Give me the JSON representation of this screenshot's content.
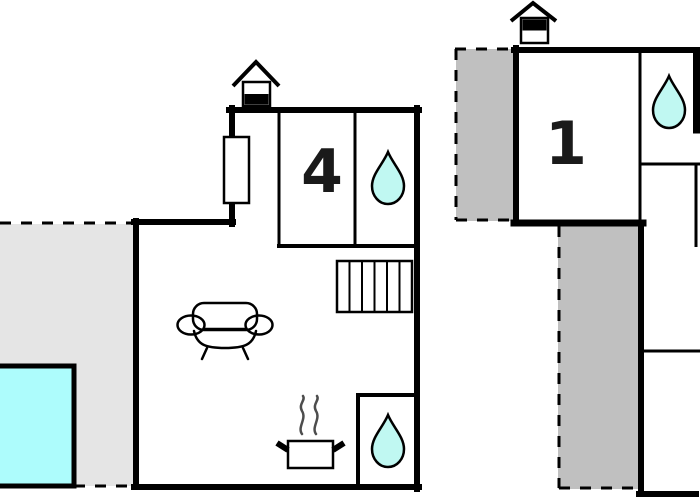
{
  "floor_plan": {
    "type": "vacation-home floor plan, two buildings",
    "labels": {
      "room4": "4",
      "room1": "1"
    },
    "icons": {
      "chimney": "house-chimney-icon",
      "water_drop": "water-drop-icon",
      "sofa": "sofa-icon",
      "stove": "stove-steam-icon",
      "stairs": "stairs-icon",
      "window": "window-icon",
      "pool": "pool-square",
      "terrace": "dashed-terrace-area"
    },
    "colors": {
      "wall": "#000000",
      "terrace_light": "#e5e5e5",
      "terrace_dark": "#c0c0c0",
      "pool": "#adfcfc",
      "water_drop": "#c0f8f2",
      "steam": "#4d4d4d",
      "label_text": "#1a1a1a",
      "background": "#ffffff"
    }
  }
}
